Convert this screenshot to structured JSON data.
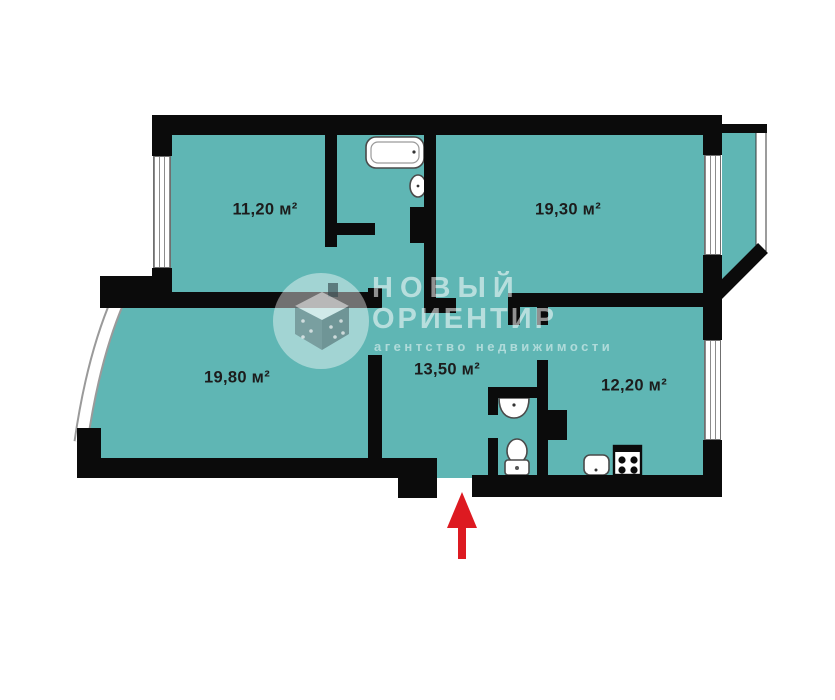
{
  "plan": {
    "title": "apartment-floor-plan",
    "floor_color": "#5fb6b4",
    "wall_color": "#0b0b0b",
    "arrow_color": "#dd1a21",
    "background": "#ffffff"
  },
  "rooms": [
    {
      "name": "room-top-left",
      "area_label": "11,20 м²"
    },
    {
      "name": "room-top-right",
      "area_label": "19,30 м²"
    },
    {
      "name": "room-bottom-left",
      "area_label": "19,80 м²"
    },
    {
      "name": "hallway",
      "area_label": "13,50 м²"
    },
    {
      "name": "kitchen",
      "area_label": "12,20 м²"
    }
  ],
  "fixtures": [
    "bathtub",
    "bathroom-sink",
    "wc-sink",
    "toilet",
    "kitchen-sink",
    "stove",
    "balcony",
    "bay-window",
    "entrance-arrow"
  ],
  "watermark": {
    "line1": "НОВЫЙ",
    "line2": "ОРИЕНТИР",
    "tagline": "агентство недвижимости"
  }
}
